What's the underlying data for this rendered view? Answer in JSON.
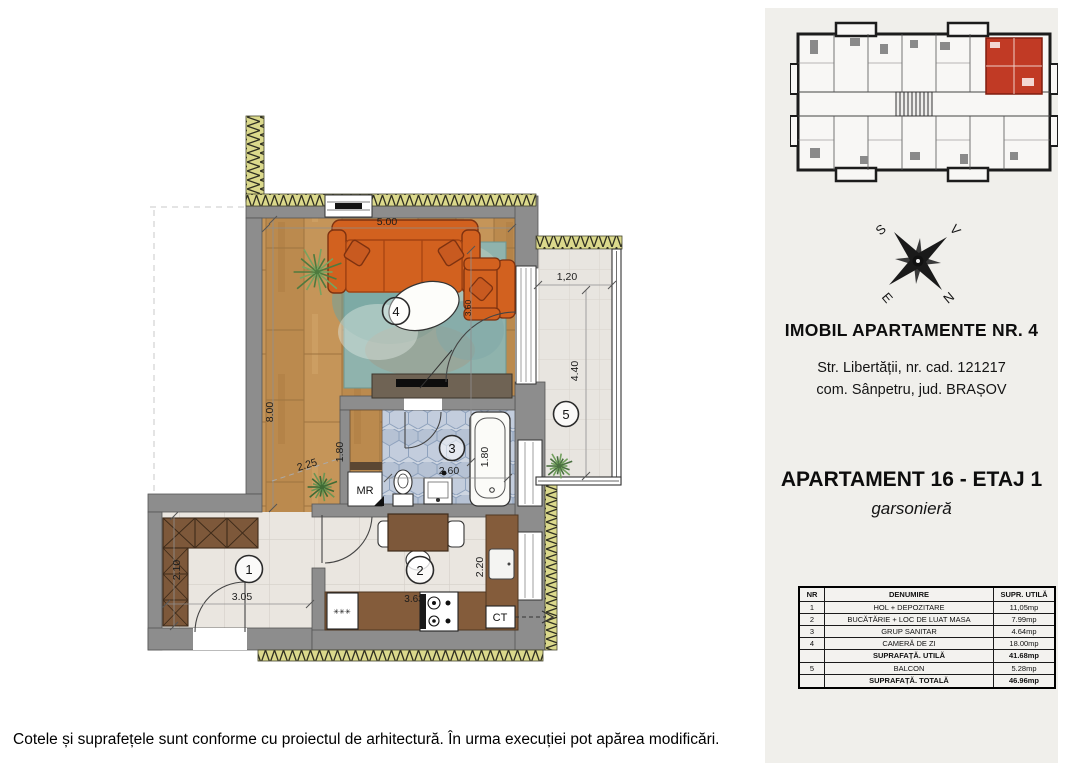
{
  "plan": {
    "dims": {
      "living_width": "5.00",
      "living_depth": "3.60",
      "left_total": "8.00",
      "corridor": "2.25",
      "storage_height": "1.80",
      "bath_width": "2.60",
      "bath_depth": "1.80",
      "balcony_width": "1,20",
      "balcony_length": "4.40",
      "hall_depth": "2.10",
      "hall_width": "3.05",
      "kitchen_width": "3.63",
      "kitchen_depth": "2.20"
    },
    "room_numbers": {
      "hall": "1",
      "kitchen": "2",
      "bathroom": "3",
      "living": "4",
      "balcony": "5"
    },
    "labels": {
      "washing_machine": "MR",
      "boiler": "CT",
      "freezer_symbol": "✳✳✳"
    }
  },
  "compass": {
    "n": "N",
    "s": "S",
    "e": "E",
    "v": "V"
  },
  "sidebar": {
    "building_title": "IMOBIL APARTAMENTE NR. 4",
    "address_line1": "Str. Libertății, nr. cad. 121217",
    "address_line2": "com. Sânpetru, jud. BRAȘOV",
    "apartment_title": "APARTAMENT 16 - ETAJ 1",
    "apartment_type": "garsonieră",
    "table": {
      "headers": {
        "nr": "NR",
        "name": "DENUMIRE",
        "area": "SUPR. UTILĂ"
      },
      "rows": [
        {
          "nr": "1",
          "name": "HOL + DEPOZITARE",
          "area": "11,05mp"
        },
        {
          "nr": "2",
          "name": "BUCĂTĂRIE + LOC DE LUAT MASA",
          "area": "7.99mp"
        },
        {
          "nr": "3",
          "name": "GRUP SANITAR",
          "area": "4.64mp"
        },
        {
          "nr": "4",
          "name": "CAMERĂ DE ZI",
          "area": "18.00mp"
        },
        {
          "nr": "",
          "name": "SUPRAFAȚĂ. UTILĂ",
          "area": "41.68mp"
        },
        {
          "nr": "5",
          "name": "BALCON",
          "area": "5.28mp"
        },
        {
          "nr": "",
          "name": "SUPRAFAȚĂ. TOTALĂ",
          "area": "46.96mp"
        }
      ]
    }
  },
  "footer": {
    "text": "Cotele și suprafețele sunt conforme cu proiectul de arhitectură. În urma execuției pot apărea modificări."
  }
}
